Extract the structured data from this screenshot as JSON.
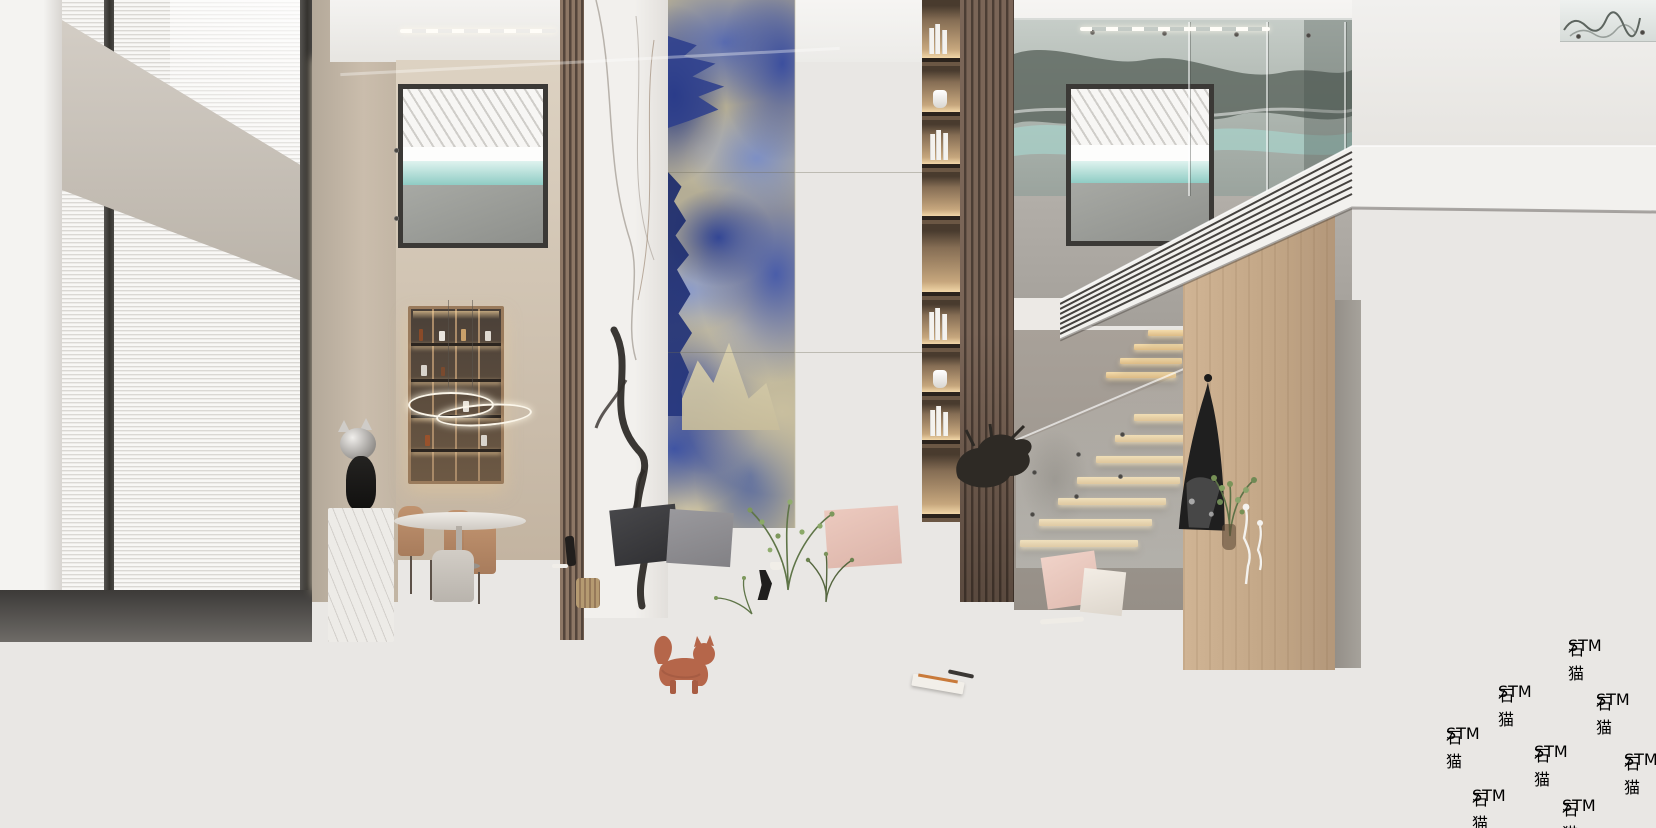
{
  "meta": {
    "type": "3d-architectural-interior-render",
    "description": "Double-height modern luxury living room: blue sodalite marble feature wall flanked by a white Calacatta marble column and backlit display niches, wood slat panels, tan leather sofa with scatter cushions, black leather bench, grey wing armchair with throw, round white-marble and black coffee tables, brass side table, terracotta cat figurine on a grey rug, dining nook with illuminated cabinet and ring chandelier, floating timber staircase with glass balustrade, leaning monochrome artwork over a floating marble console, grey stone tile floor."
  },
  "watermark": {
    "brand": "STM",
    "cjk": "石猫",
    "full_text": "STM石猫",
    "placement": "diagonal repeated tiles, bottom-right corner",
    "color": "#ffffff",
    "opacity": 0.55
  },
  "palette": {
    "blue_marble_deep": "#24367f",
    "blue_marble_mid": "#4a5da9",
    "blue_marble_light": "#8b9bcb",
    "marble_cream": "#d4cbab",
    "calacatta_white": "#f1efec",
    "wood_slat": "#6f5c4e",
    "oak_panel": "#c2a686",
    "sofa_tan": "#b08165",
    "bench_black": "#2a2a2c",
    "armchair_grey": "#b6b2ac",
    "cat_terracotta": "#b5664a",
    "brass_gold": "#c99a5d",
    "floor_grey": "#d2cfca",
    "teal_view": "#8fccc4",
    "led_warm": "#f1d6a7"
  },
  "scene": {
    "objects": [
      "left-window-blinds",
      "concrete-slab-band",
      "dining-display-cabinet",
      "ring-chandelier",
      "dining-table",
      "dining-chairs",
      "chrome-cat-head-sculpture",
      "marble-plinth",
      "wood-slat-column",
      "calacatta-marble-column",
      "blue-sodalite-feature-wall",
      "backlit-display-niches",
      "wood-slat-panel",
      "mezzanine-window",
      "art-glass-mirror-wall",
      "glass-balustrade",
      "striped-slab-fascia",
      "floating-staircase",
      "oak-feature-wall",
      "leaning-monochrome-artwork",
      "floating-marble-console",
      "console-plant",
      "white-wire-figurines",
      "bronze-sculpture",
      "stone-plinth",
      "tan-leather-sofa",
      "scatter-cushions",
      "centre-console-table",
      "olive-branch-plant",
      "white-marble-coffee-table",
      "black-coffee-table",
      "brass-side-table",
      "black-leather-bench",
      "wood-armrest",
      "grey-wing-armchair",
      "knit-throw-blanket",
      "tripod-floor-lamp",
      "black-side-table",
      "terracotta-cat-figurine",
      "area-rug",
      "magazine",
      "stone-tile-floor",
      "watermark"
    ]
  }
}
